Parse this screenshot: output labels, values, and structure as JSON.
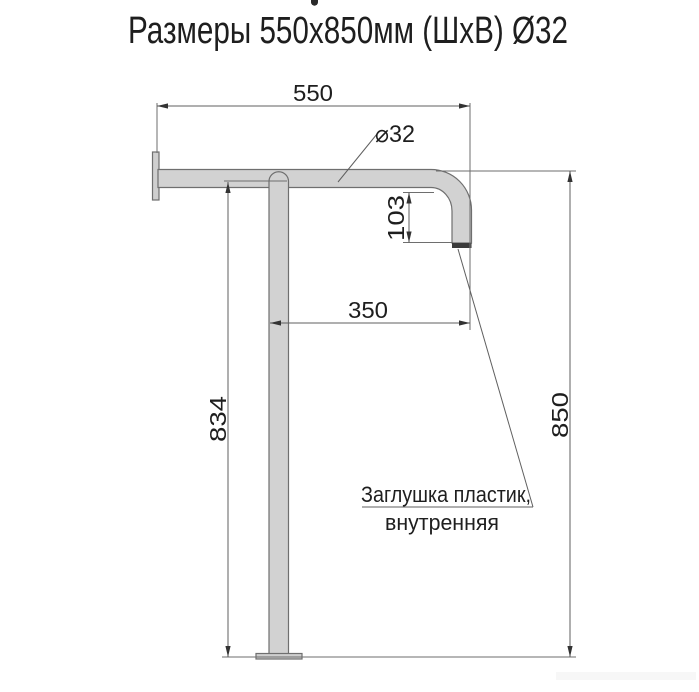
{
  "title": "Размеры 550x850мм (ШхВ) Ø32",
  "drawing": {
    "dim_width": "550",
    "dim_diameter": "⌀32",
    "dim_end_drop": "103",
    "dim_post_offset": "350",
    "dim_post_height": "834",
    "dim_total_height": "850",
    "note_line1": "Заглушка пластик,",
    "note_line2": "внутренняя"
  },
  "colors": {
    "tube_fill": "#d2d2d2",
    "flange_fill": "#cfcfcf",
    "end_cap": "#3a3a3a",
    "arrow": "#333333",
    "text": "#1e1e1e"
  }
}
